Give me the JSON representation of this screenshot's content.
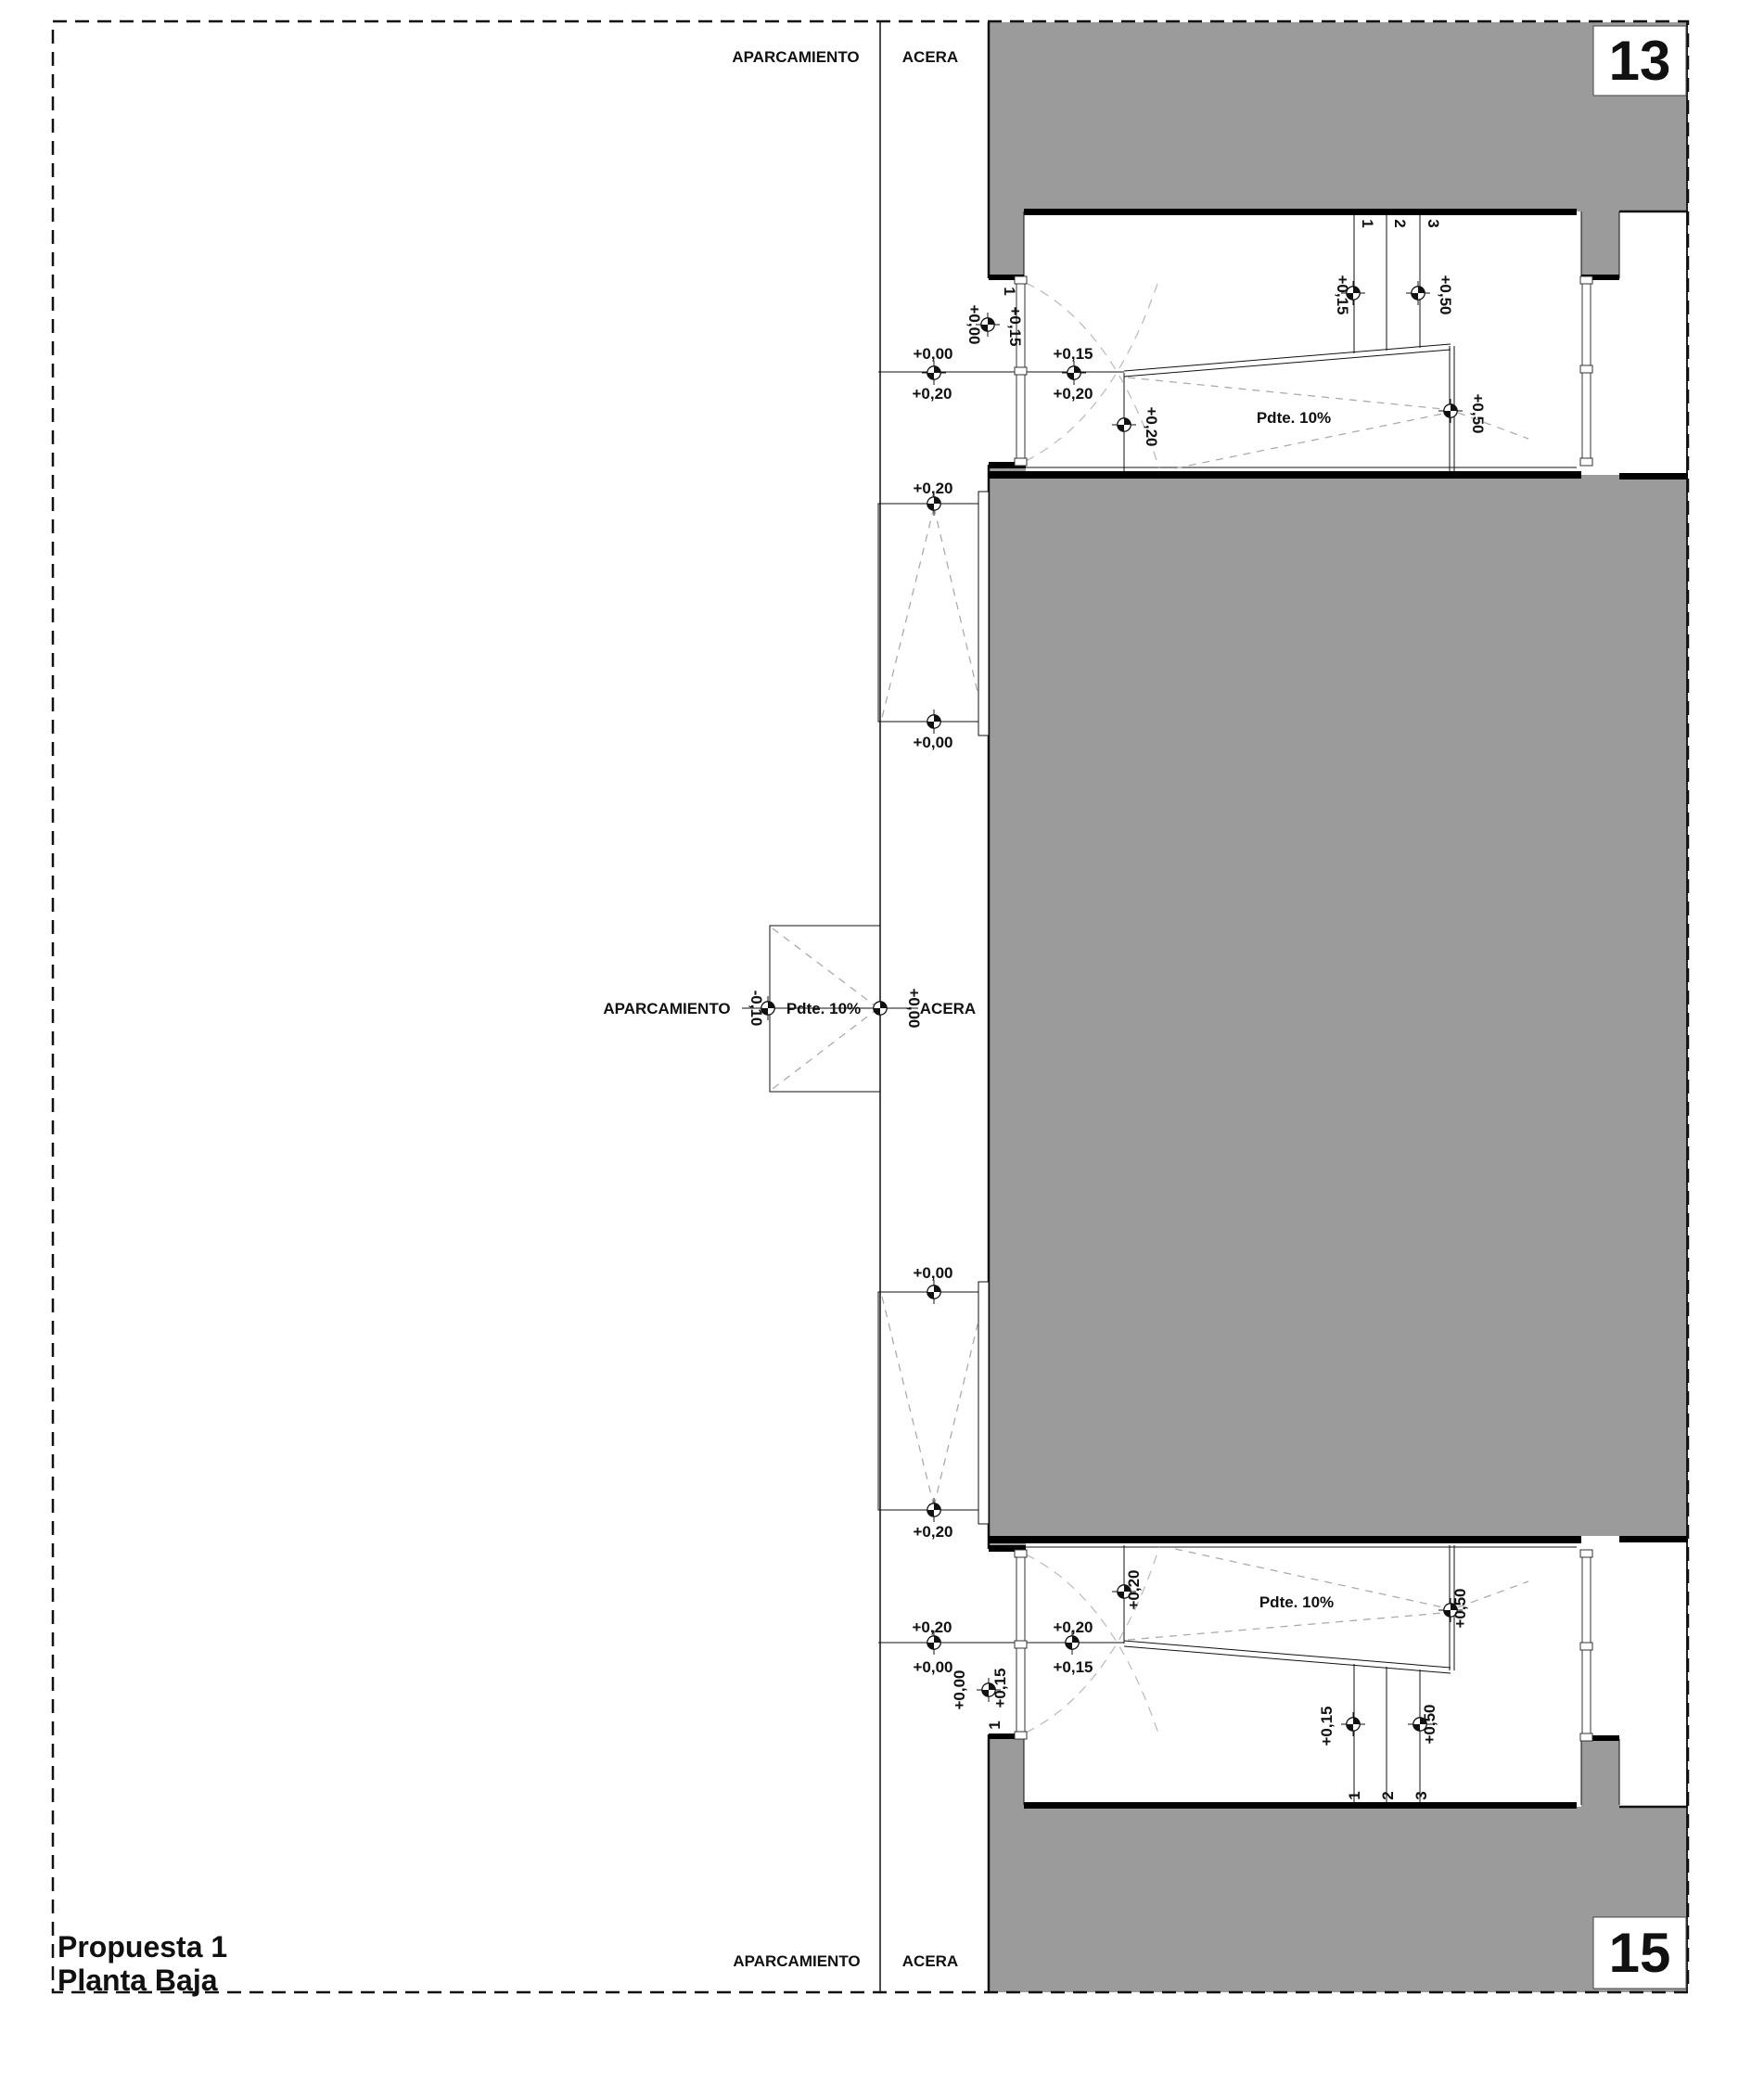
{
  "colors": {
    "mass": "#9b9b9b",
    "ink": "#111111",
    "path_dash": "#ababab",
    "arc_dash": "#bdbdbd"
  },
  "title": {
    "line1": "Propuesta 1",
    "line2": "Planta Baja"
  },
  "sheet_numbers": {
    "top": "13",
    "bottom": "15"
  },
  "streets": {
    "top": {
      "parking": "APARCAMIENTO",
      "sidewalk": "ACERA"
    },
    "bottom": {
      "parking": "APARCAMIENTO",
      "sidewalk": "ACERA"
    },
    "crossing": {
      "parking": "APARCAMIENTO",
      "parking_level": "-0,10",
      "slope": "Pdte. 10%",
      "sidewalk_level": "+0,00",
      "sidewalk": "ACERA"
    }
  },
  "sidewalk_ramps": {
    "upper": {
      "top_level": "+0,20",
      "bottom_level": "+0,00"
    },
    "lower": {
      "top_level": "+0,00",
      "bottom_level": "+0,20"
    }
  },
  "garage_top": {
    "win_out": "+0,00",
    "win_in": "+0,15",
    "win_num": "1",
    "cross1_top": "+0,00",
    "cross1_bottom": "+0,20",
    "cross2_top": "+0,15",
    "cross2_bottom": "+0,20",
    "ramp_start": "+0,20",
    "slope": "Pdte. 10%",
    "ramp_end": "+0,50",
    "steps": {
      "n1": "1",
      "n2": "2",
      "n3": "3",
      "low": "+0,15",
      "high": "+0,50"
    }
  },
  "garage_bottom": {
    "win_out": "+0,00",
    "win_in": "+0,15",
    "win_num": "1",
    "cross1_top": "+0,20",
    "cross1_bottom": "+0,00",
    "cross2_top": "+0,20",
    "cross2_bottom": "+0,15",
    "ramp_start": "+0,20",
    "slope": "Pdte. 10%",
    "ramp_end": "+0,50",
    "steps": {
      "n1": "1",
      "n2": "2",
      "n3": "3",
      "low": "+0,15",
      "high": "+0,50"
    }
  }
}
